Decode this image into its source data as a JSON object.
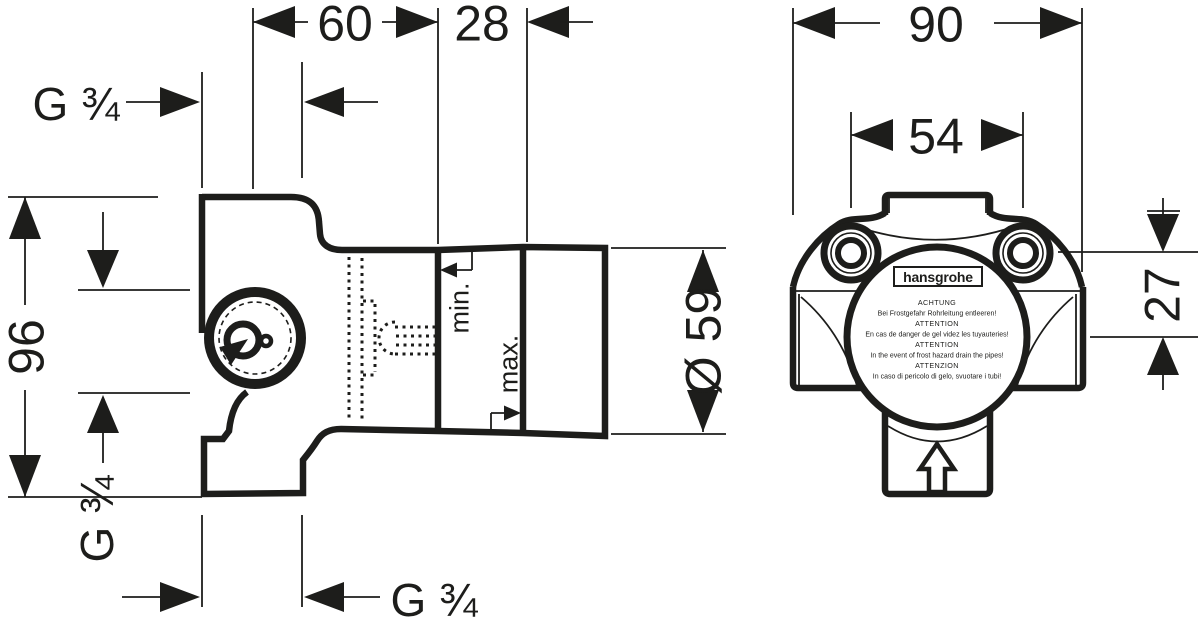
{
  "colors": {
    "ink": "#1d1d1b",
    "background": "#ffffff"
  },
  "side_view": {
    "dim_width": "60",
    "dim_offset": "28",
    "dim_height": "96",
    "dim_cap_diameter": "Ø 59",
    "thread_top": "G ¾",
    "thread_side": "G ¾",
    "thread_bottom": "G ¾",
    "min_label": "min.",
    "max_label": "max."
  },
  "front_view": {
    "dim_body_width": "90",
    "dim_hole_spacing": "54",
    "dim_hole_offset": "27",
    "brand": "hansgrohe",
    "warnings": [
      "ACHTUNG",
      "Bei Frostgefahr Rohrleitung entleeren!",
      "ATTENTION",
      "En cas de danger de gel videz les tuyauteries!",
      "ATTENTION",
      "In the event of frost hazard drain the pipes!",
      "ATTENZION",
      "In caso di pericolo di gelo, svuotare i tubi!"
    ]
  }
}
